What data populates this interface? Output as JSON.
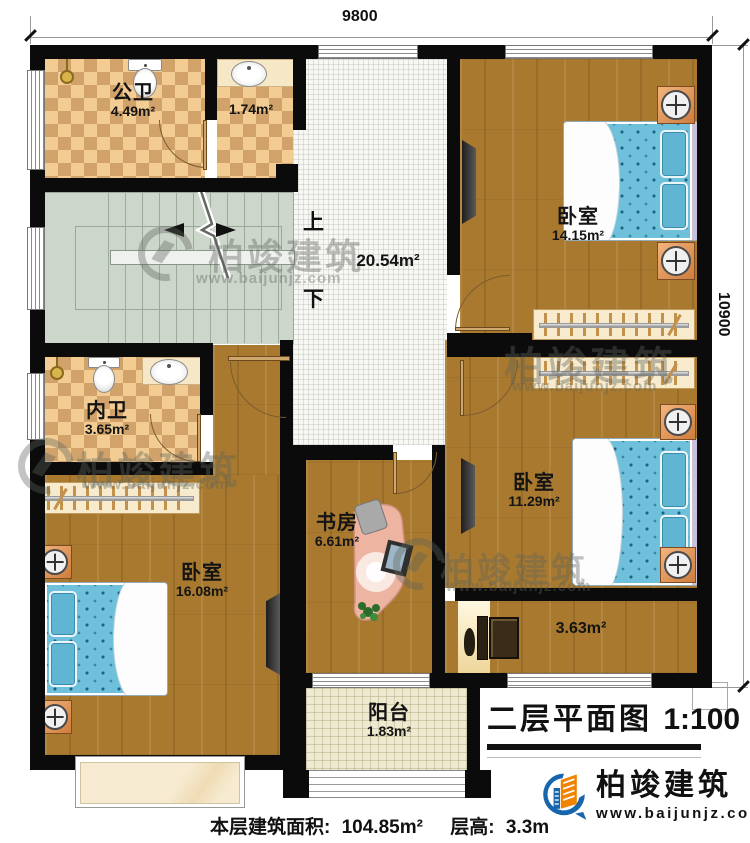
{
  "dimensions": {
    "top_width": "9800",
    "right_height": "10900"
  },
  "stairs": {
    "up_label": "上",
    "down_label": "下"
  },
  "rooms": [
    {
      "name": "公卫",
      "area": "4.49m²"
    },
    {
      "name": "",
      "area": "1.74m²"
    },
    {
      "name": "",
      "area": "20.54m²"
    },
    {
      "name": "卧室",
      "area": "14.15m²"
    },
    {
      "name": "内卫",
      "area": "3.65m²"
    },
    {
      "name": "卧室",
      "area": "11.29m²"
    },
    {
      "name": "书房",
      "area": "6.61m²"
    },
    {
      "name": "卧室",
      "area": "16.08m²"
    },
    {
      "name": "",
      "area": "3.63m²"
    },
    {
      "name": "阳台",
      "area": "1.83m²"
    }
  ],
  "title_block": {
    "plan_title": "二层平面图",
    "scale": "1:100"
  },
  "footer": {
    "area_label": "本层建筑面积:",
    "area_value": "104.85m²",
    "height_label": "层高:",
    "height_value": "3.3m"
  },
  "branding": {
    "company": "柏竣建筑",
    "website": "www.baijunjz.com"
  },
  "watermark": {
    "company": "柏竣建筑",
    "website": "www.baijunjz.com"
  }
}
